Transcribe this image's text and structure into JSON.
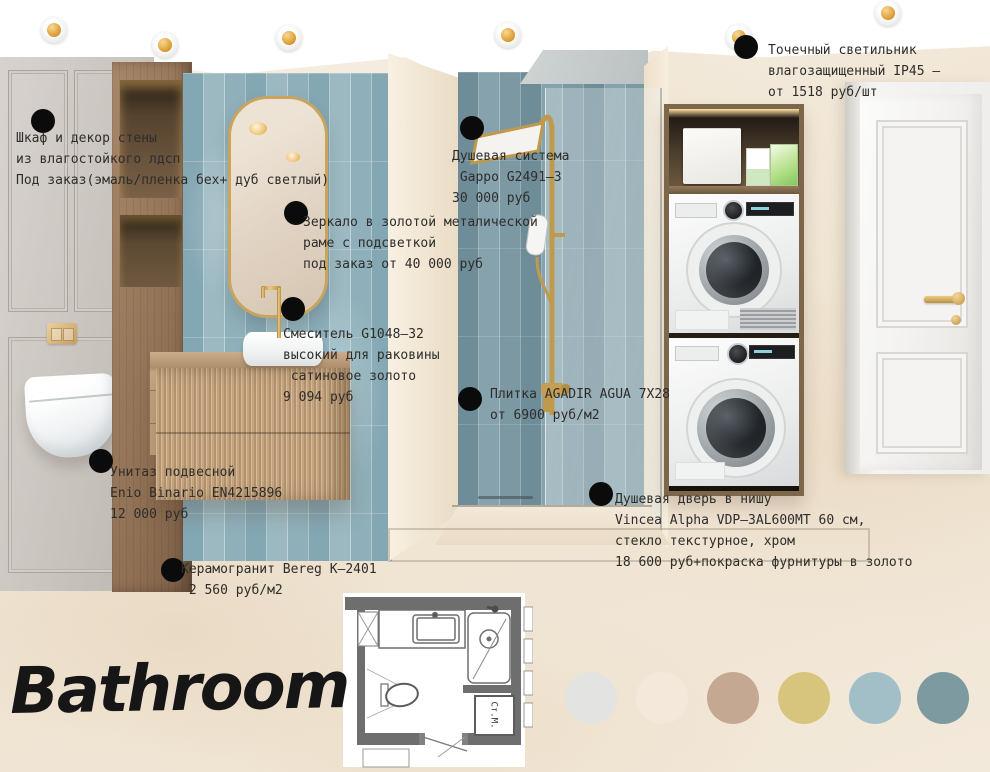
{
  "title": "Bathroom",
  "annotations": {
    "spotlight": {
      "text": "Точечный светильник\nвлагозащищенный IP45 –\nот 1518 руб/шт"
    },
    "cabinet": {
      "text": "Шкаф и декор стены\nиз влагостойкого лдсп\nПод заказ(эмаль/пленка бех+ дуб светлый)"
    },
    "mirror": {
      "text": "Зеркало в золотой металической\nраме с подсветкой\nпод заказ от 40 000 руб"
    },
    "faucet": {
      "text": "Смеситель G1048–32\nвысокий для раковины\n сатиновое золото\n9 094 руб"
    },
    "shower": {
      "text": "Душевая система\n Gappo G2491–3\n30 000 руб"
    },
    "tile": {
      "text": "Плитка AGADIR AGUA 7X28\nот 6900 руб/м2"
    },
    "toilet": {
      "text": "Унитаз подвесной\nEnio Binario EN4215896\n12 000 руб"
    },
    "floor_tile": {
      "text": "Керамогранит Bereg К–2401\n 2 560 руб/м2"
    },
    "shower_door": {
      "text": "Душевая дверь в нишу\nVincea Alpha VDP–3AL600MT 60 см,\nстекло текстурное, хром\n18 600 руб+покраска фурнитуры в золото"
    }
  },
  "floor_plan": {
    "washer_label": "Ст.М."
  },
  "palette": {
    "colors": [
      "#e3e3e1",
      "#f4e8da",
      "#c4a892",
      "#d8c57d",
      "#a2bfc8",
      "#7d9aa1"
    ]
  }
}
